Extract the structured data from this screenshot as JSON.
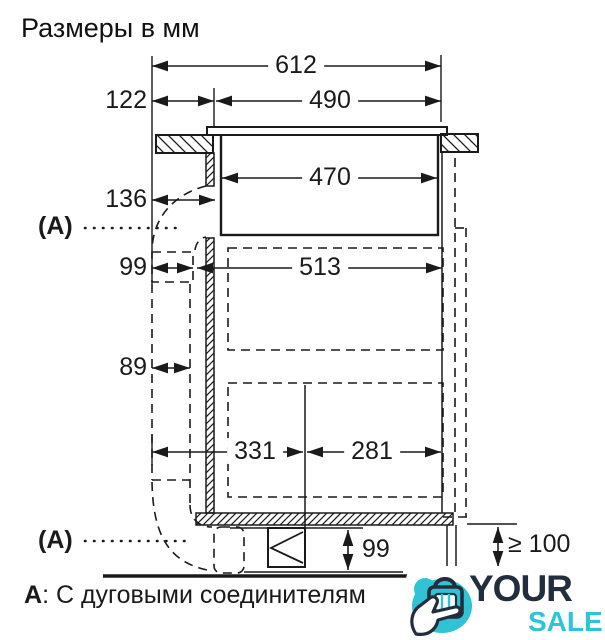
{
  "title": "Размеры в мм",
  "diagram": {
    "dims": {
      "top_width": "612",
      "cutout_width": "490",
      "left_offset": "122",
      "body_width": "470",
      "duct_offset": "136",
      "duct_connector_width": "99",
      "cabinet_inner_width": "513",
      "duct_width": "89",
      "outlet_left": "331",
      "outlet_right": "281",
      "plinth_height": "99",
      "floor_clearance": "≥ 100"
    },
    "section_label_top": "(A)",
    "section_label_bottom": "(A)",
    "caption_prefix": "А",
    "caption_text": ": С дуговыми соединителям"
  },
  "watermark": {
    "word_top": "YOUR",
    "word_bottom": "SALE",
    "accent_color": "#2fc3d5",
    "dark_color": "#232e3d"
  }
}
